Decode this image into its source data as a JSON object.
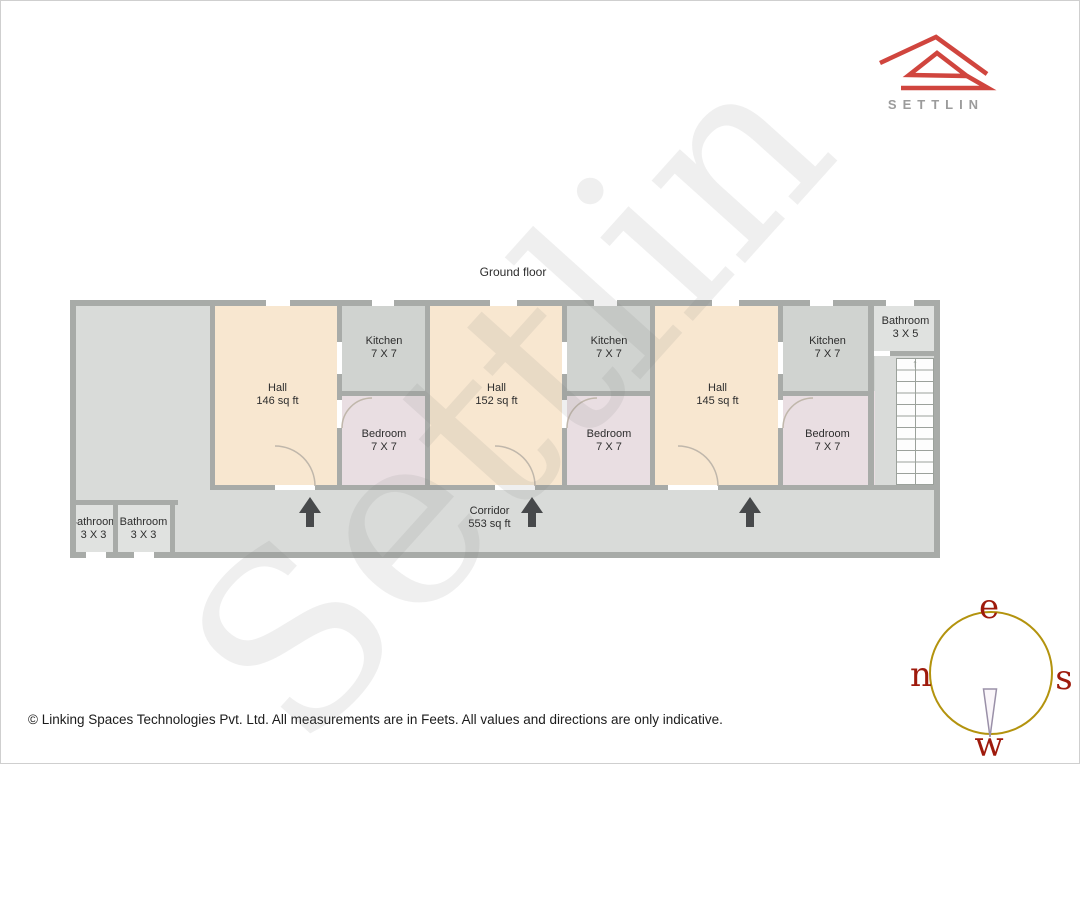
{
  "logo": {
    "brand": "SETTLIN",
    "icon": "settlin-house-logo",
    "brand_color": "#d0453e",
    "text_color": "#9b9b9b"
  },
  "title": "Ground floor",
  "watermark": "Settlin",
  "plan": {
    "rooms": [
      {
        "id": "hall-1",
        "name": "Hall",
        "dims": "146 sq ft"
      },
      {
        "id": "kitchen-1",
        "name": "Kitchen",
        "dims": "7 X 7"
      },
      {
        "id": "bedroom-1",
        "name": "Bedroom",
        "dims": "7 X 7"
      },
      {
        "id": "hall-2",
        "name": "Hall",
        "dims": "152 sq ft"
      },
      {
        "id": "kitchen-2",
        "name": "Kitchen",
        "dims": "7 X 7"
      },
      {
        "id": "bedroom-2",
        "name": "Bedroom",
        "dims": "7 X 7"
      },
      {
        "id": "hall-3",
        "name": "Hall",
        "dims": "145 sq ft"
      },
      {
        "id": "kitchen-3",
        "name": "Kitchen",
        "dims": "7 X 7"
      },
      {
        "id": "bedroom-3",
        "name": "Bedroom",
        "dims": "7 X 7"
      },
      {
        "id": "bathroom-right",
        "name": "Bathroom",
        "dims": "3 X 5"
      },
      {
        "id": "bathroom-left-1",
        "name": "Bathroom",
        "dims": "3 X 3"
      },
      {
        "id": "bathroom-left-2",
        "name": "Bathroom",
        "dims": "3 X 3"
      },
      {
        "id": "corridor",
        "name": "Corridor",
        "dims": "553 sq ft"
      }
    ],
    "stairs": {
      "icon": "stairs-up-arrow",
      "glyph": "↑",
      "direction": "up"
    },
    "direction_arrows": {
      "count": 3,
      "direction": "up"
    }
  },
  "compass": {
    "top": "e",
    "left": "n",
    "right": "s",
    "bottom": "w",
    "ring_color": "#b3930e",
    "letter_color": "#9e1a0c"
  },
  "footer": "© Linking Spaces Technologies Pvt. Ltd. All measurements are in Feets. All values and directions are only indicative.",
  "colors": {
    "hall": "#f8e7d0",
    "bedroom": "#e9dee2",
    "kitchen": "#d0d3d0",
    "bathroom": "#e0e2e0",
    "wall": "#a8aba8",
    "floor": "#d9dbd9",
    "arrow": "#47494b",
    "logo_red": "#d0453e"
  }
}
